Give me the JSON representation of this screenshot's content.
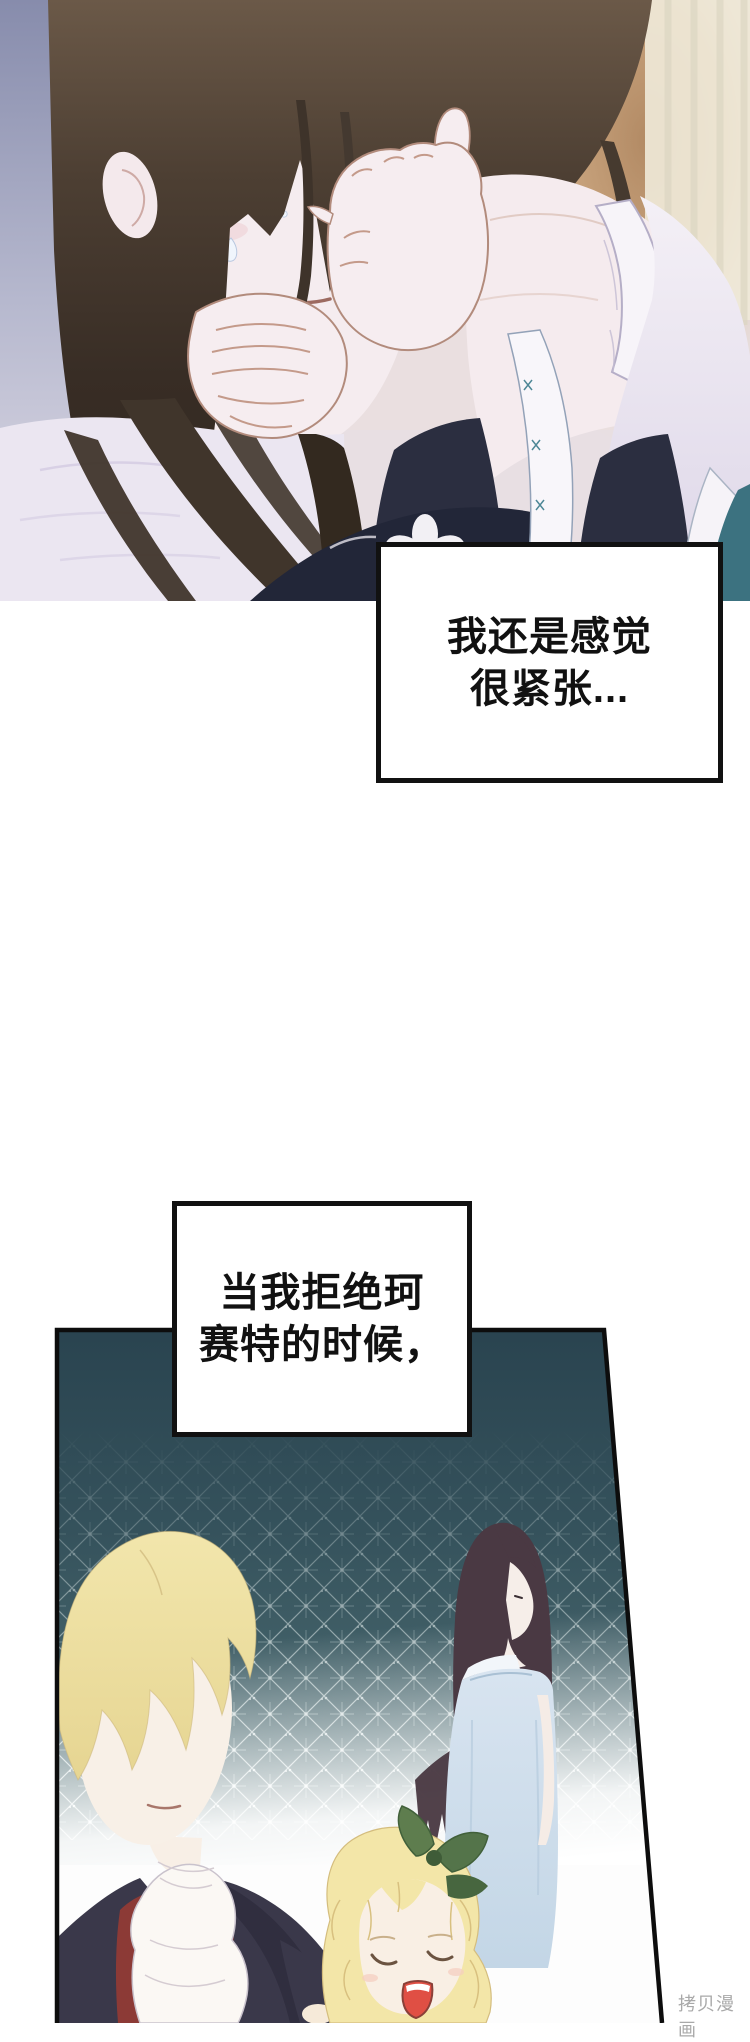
{
  "page": {
    "width": 750,
    "height": 2023,
    "background": "#ffffff",
    "watermark_text": "拷贝漫画"
  },
  "speech_boxes": [
    {
      "lines": [
        "我还是感觉",
        "很紧张..."
      ]
    },
    {
      "lines": [
        "当我拒绝珂",
        "赛特的时候，"
      ]
    }
  ],
  "panels": [
    {
      "id": "panel-1",
      "description": "Close-up of a long dark-haired young woman, eyes closed and tearful, raising a hand to wipe her tears; white ruffled sleeves and dark floral dress; lavender and warm-lit room background"
    },
    {
      "id": "panel-2",
      "description": "Memory scene on a teal lace background: blonde man in dark coat, red vest and white cravat; long dark-haired girl in pale blue dress; laughing blonde child with a green leaf ribbon"
    }
  ],
  "colors": {
    "speech_text": "#111111",
    "speech_border": "#111111",
    "panel2_teal": "#2e4b57",
    "watermark_gray": "#a9a9a9",
    "hair_dark_brown": "#43382e",
    "hair_blonde": "#eee2a0",
    "skin_pale": "#f6edf0",
    "dress_light_blue": "#cdddeb",
    "vest_dark_red": "#8c3a36",
    "coat_navy": "#3a384a",
    "mouth_red": "#e0504a",
    "leaf_green": "#57754b",
    "background_lavender": "#b6b8ce",
    "background_warm": "#b28a64"
  }
}
